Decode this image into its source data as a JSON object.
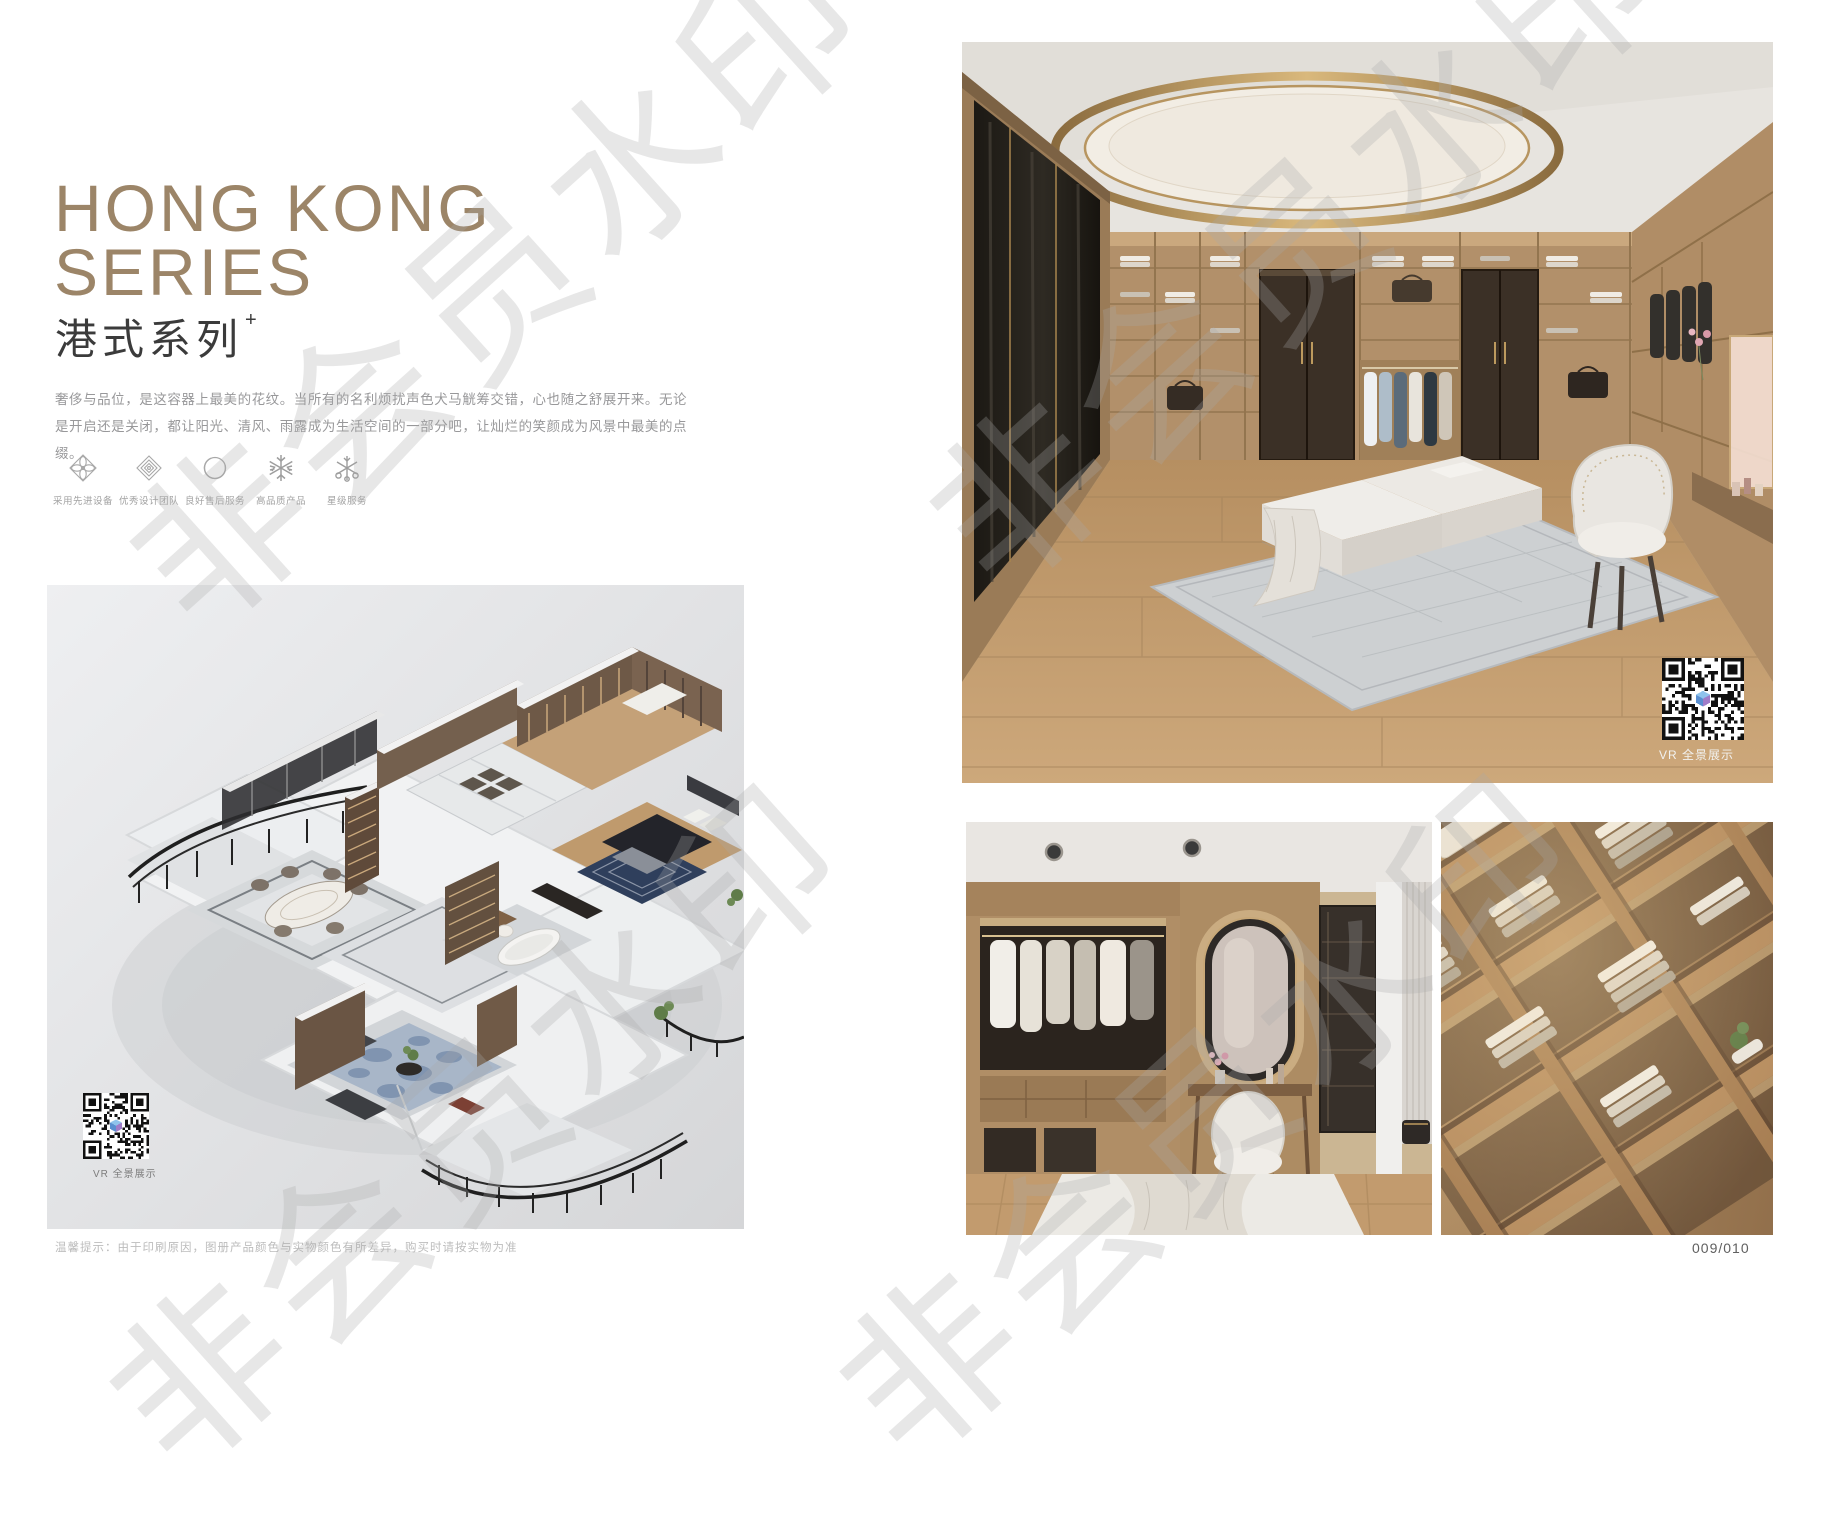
{
  "header": {
    "title_line1": "HONG KONG",
    "title_line2": "SERIES",
    "subtitle_cn": "港式系列",
    "subtitle_sup": "+",
    "description": "奢侈与品位，是这容器上最美的花纹。当所有的名利烦扰声色犬马觥筹交错，心也随之舒展开来。无论是开启还是关闭，都让阳光、清风、雨露成为生活空间的一部分吧，让灿烂的笑颜成为风景中最美的点缀。"
  },
  "features": [
    {
      "icon": "ornament-petal-icon",
      "label": "采用先进设备"
    },
    {
      "icon": "ornament-diamond-icon",
      "label": "优秀设计团队"
    },
    {
      "icon": "ring-icon",
      "label": "良好售后服务"
    },
    {
      "icon": "snowflake-icon",
      "label": "高品质产品"
    },
    {
      "icon": "star-service-icon",
      "label": "星级服务"
    }
  ],
  "floorplan_panel": {
    "vr_label": "VR 全景展示"
  },
  "gallery": {
    "main_vr_label": "VR 全景展示"
  },
  "watermark": {
    "text": "非会员水印"
  },
  "footer": {
    "disclaimer": "温馨提示：由于印刷原因，图册产品颜色与实物颜色有所差异，购买时请按实物为准",
    "page_number": "009/010"
  },
  "colors": {
    "accent_bronze": "#9c8568",
    "heading_dark": "#3b3b3b",
    "body_grey": "#98989a",
    "panel_grey": "#e4e5e7",
    "watermark_grey": "#a8a8a8",
    "gold_ring": "#c2a36a"
  }
}
